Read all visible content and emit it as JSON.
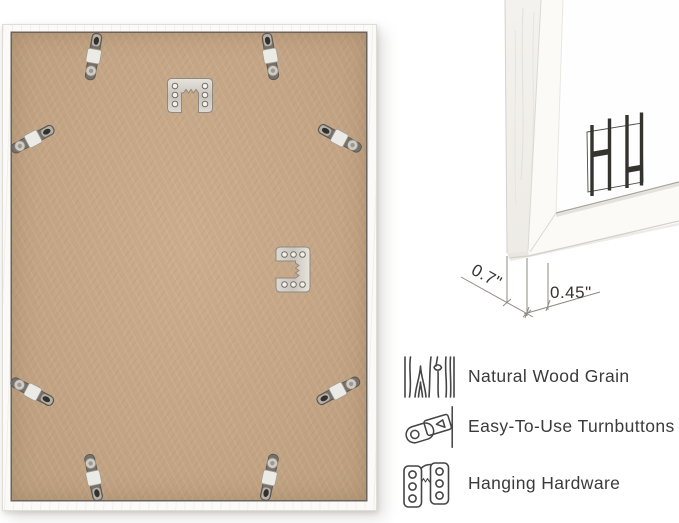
{
  "frame_back": {
    "backing_color": "#c5a686",
    "frame_color": "#fbfaf8",
    "turnbutton_count": 8,
    "hanger_count": 2
  },
  "corner_detail": {
    "logo_monogram": "HH",
    "dimensions": [
      {
        "label": "0.7\""
      },
      {
        "label": "0.45\""
      }
    ]
  },
  "features": [
    {
      "icon": "wood-grain-icon",
      "label": "Natural Wood Grain"
    },
    {
      "icon": "turnbutton-icon",
      "label": "Easy-To-Use Turnbuttons"
    },
    {
      "icon": "hanging-hardware-icon",
      "label": "Hanging Hardware"
    }
  ],
  "colors": {
    "text": "#3b3b3b",
    "annotation": "#8f8a82",
    "metal_light": "#e4e1da",
    "metal_dark": "#75716a"
  }
}
